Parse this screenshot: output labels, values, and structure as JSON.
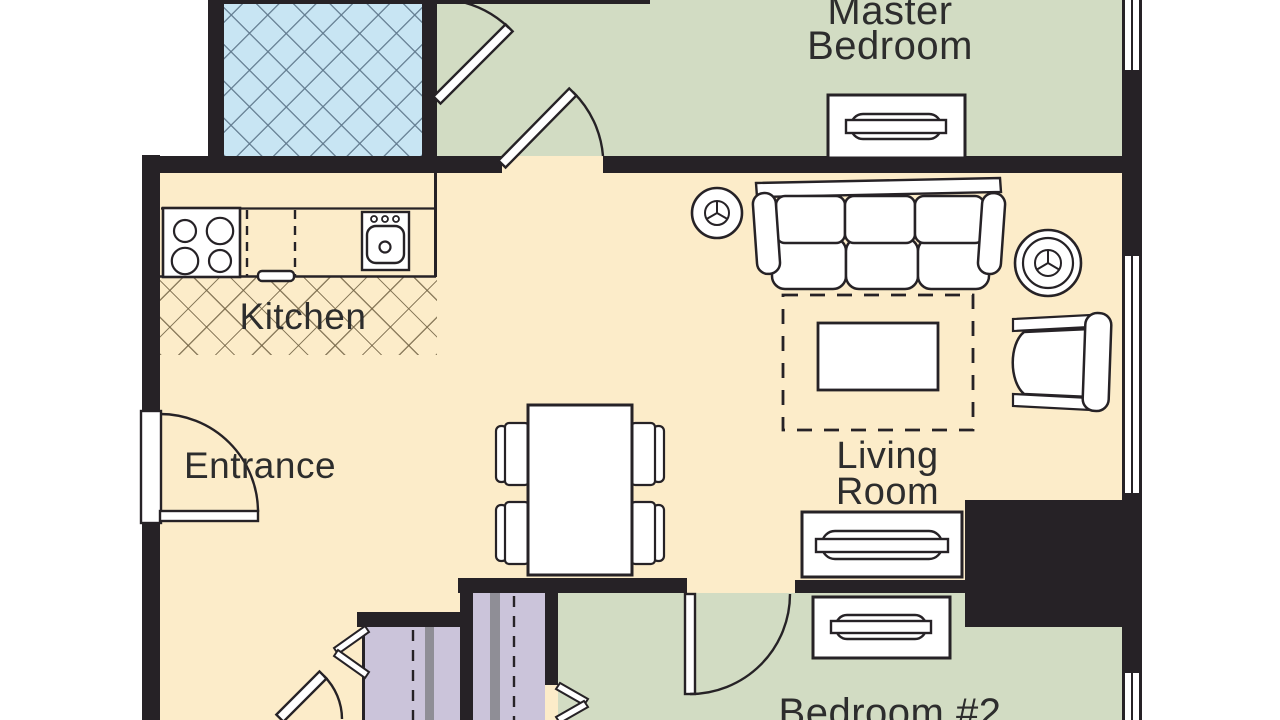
{
  "title": "Apartment floor plan",
  "rooms": {
    "master": {
      "label": "Master\nBedroom"
    },
    "kitchen": {
      "label": "Kitchen"
    },
    "entrance": {
      "label": "Entrance"
    },
    "living": {
      "label": "Living\nRoom"
    },
    "bedroom2": {
      "label": "Bedroom #2"
    }
  },
  "colors": {
    "floor_main": "#fcecc9",
    "floor_bedrooms": "#d2dcc3",
    "floor_bathroom": "#c8e5f3",
    "closet": "#cbc4da",
    "closet_track": "#8f8e96",
    "wall": "#262226",
    "label_text": "#2d2d2d",
    "furniture_fill": "#ffffff"
  }
}
